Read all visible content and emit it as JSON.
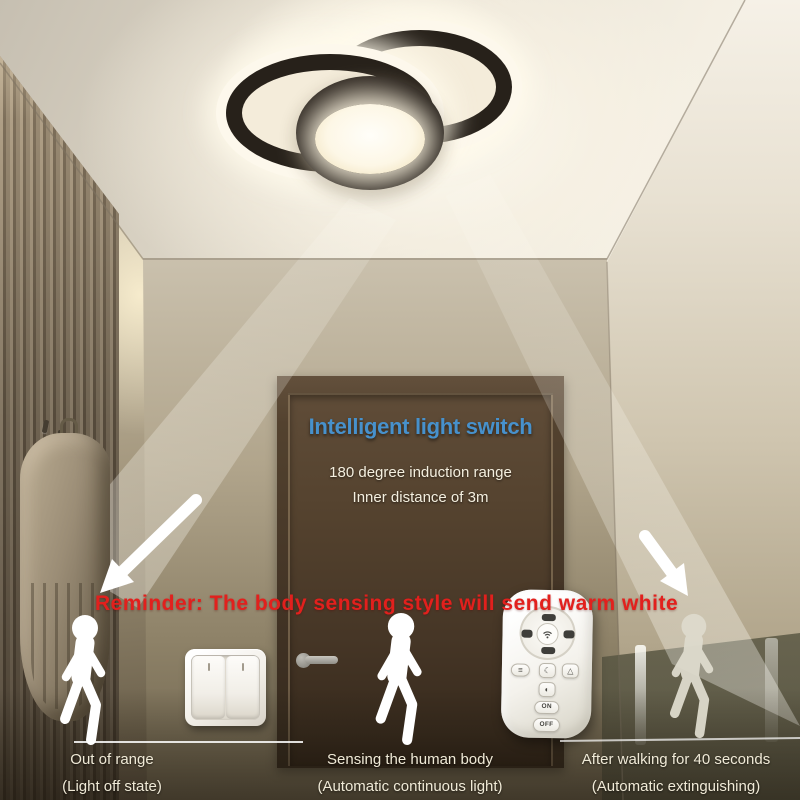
{
  "overlay": {
    "title": "Intelligent light switch",
    "line1": "180 degree induction range",
    "line2": "Inner distance of 3m",
    "reminder": "Reminder: The body sensing style will send warm white"
  },
  "captions": {
    "out_of_range": {
      "line1": "Out of range",
      "line2": "(Light off state)"
    },
    "sensing": {
      "line1": "Sensing the human body",
      "line2": "(Automatic continuous light)"
    },
    "after_walking": {
      "line1": "After walking for 40 seconds",
      "line2": "(Automatic extinguishing)"
    }
  },
  "remote": {
    "on_label": "ON",
    "off_label": "OFF",
    "icons": {
      "menu_glyph": "≡",
      "moon_glyph": "☾",
      "tent_glyph": "△",
      "brightness_glyph": "◐"
    }
  },
  "colors": {
    "title_blue": "#4791cc",
    "reminder_red": "#e2201d",
    "caption_text": "#f0ead7",
    "led_white": "#fdf8ec",
    "ring_black": "#27211a"
  }
}
